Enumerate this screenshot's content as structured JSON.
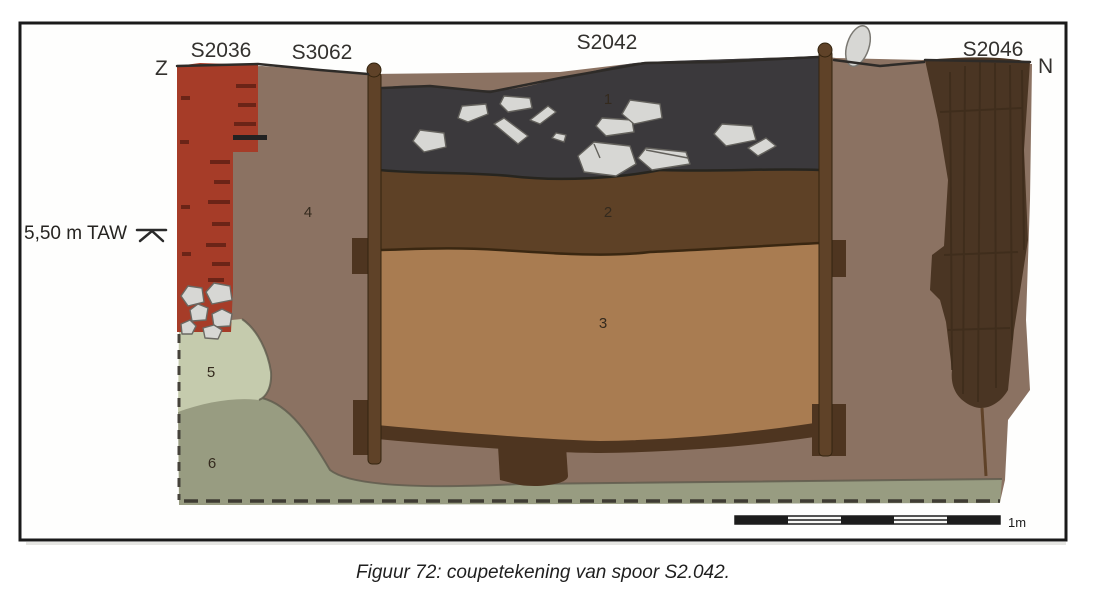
{
  "figure": {
    "caption": "Figuur 72: coupetekening van spoor S2.042."
  },
  "drawing": {
    "orientation_left": "Z",
    "orientation_right": "N",
    "elevation_label": "5,50 m TAW",
    "feature_labels": {
      "s2036": "S2036",
      "s3062": "S3062",
      "s2042": "S2042",
      "s2046": "S2046"
    },
    "layers": [
      {
        "number": "1",
        "color": "#3b393c"
      },
      {
        "number": "2",
        "color": "#5e4126"
      },
      {
        "number": "3",
        "color": "#a97c51"
      },
      {
        "number": "4",
        "color": "#8b7262"
      },
      {
        "number": "5",
        "color": "#c5cbad"
      },
      {
        "number": "6",
        "color": "#989c81"
      }
    ],
    "scale_bar": {
      "label": "1m"
    },
    "colors": {
      "brick": "#a63c28",
      "brick_joint": "#6b2417",
      "wood_post": "#5f4228",
      "wood_plank": "#4e3520",
      "wood_s2046": "#4a3523",
      "stone": "#d7d7d4",
      "outline": "#2e2b28",
      "frame": "#1a1a1a"
    }
  }
}
